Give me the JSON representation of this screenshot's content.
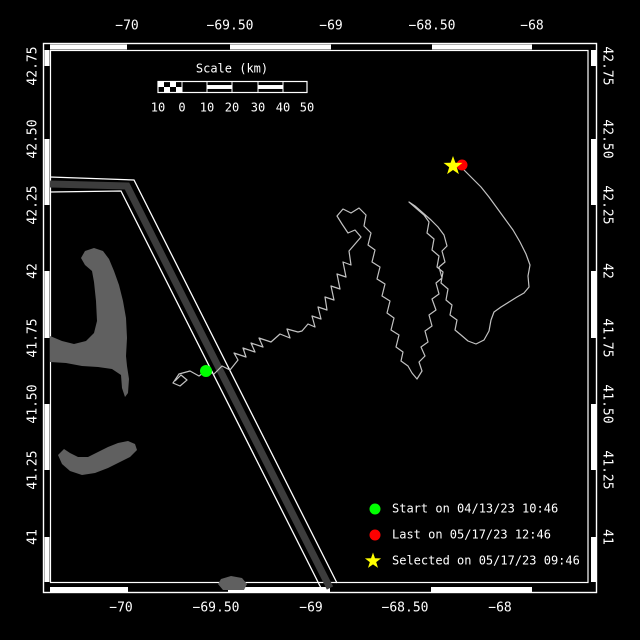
{
  "canvas": {
    "width": 640,
    "height": 640,
    "background": "#000000"
  },
  "frame": {
    "color": "#ffffff",
    "outer": [
      43.5,
      43.5,
      553,
      549
    ],
    "inner": [
      50.5,
      50.5,
      537.5,
      532
    ],
    "zebra": {
      "thickness": 5,
      "top_white": [
        [
          50,
          127
        ],
        [
          230,
          331
        ],
        [
          432,
          532
        ]
      ],
      "bottom_white": [
        [
          50,
          128
        ],
        [
          228,
          330
        ],
        [
          431,
          532
        ]
      ],
      "left_white": [
        [
          50,
          66
        ],
        [
          139,
          205
        ],
        [
          271,
          338
        ],
        [
          404,
          470
        ],
        [
          537,
          582
        ]
      ],
      "right_white": [
        [
          50,
          66
        ],
        [
          139,
          205
        ],
        [
          271,
          338
        ],
        [
          404,
          470
        ],
        [
          537,
          582
        ]
      ]
    }
  },
  "axes": {
    "top": {
      "y": 26,
      "labels": [
        {
          "text": "−70",
          "x": 127
        },
        {
          "text": "−69.50",
          "x": 230
        },
        {
          "text": "−69",
          "x": 331
        },
        {
          "text": "−68.50",
          "x": 432
        },
        {
          "text": "−68",
          "x": 532
        }
      ]
    },
    "bottom": {
      "y": 608,
      "labels": [
        {
          "text": "−70",
          "x": 121
        },
        {
          "text": "−69.50",
          "x": 216
        },
        {
          "text": "−69",
          "x": 311
        },
        {
          "text": "−68.50",
          "x": 405
        },
        {
          "text": "−68",
          "x": 500
        }
      ]
    },
    "left": {
      "x": 33,
      "labels": [
        {
          "text": "42.75",
          "y": 66
        },
        {
          "text": "42.50",
          "y": 139
        },
        {
          "text": "42.25",
          "y": 205
        },
        {
          "text": "42",
          "y": 271
        },
        {
          "text": "41.75",
          "y": 338
        },
        {
          "text": "41.50",
          "y": 404
        },
        {
          "text": "41.25",
          "y": 470
        },
        {
          "text": "41",
          "y": 537
        }
      ]
    },
    "right": {
      "x": 607,
      "labels": [
        {
          "text": "42.75",
          "y": 66
        },
        {
          "text": "42.50",
          "y": 139
        },
        {
          "text": "42.25",
          "y": 205
        },
        {
          "text": "42",
          "y": 271
        },
        {
          "text": "41.75",
          "y": 338
        },
        {
          "text": "41.50",
          "y": 404
        },
        {
          "text": "41.25",
          "y": 470
        },
        {
          "text": "41",
          "y": 537
        }
      ]
    }
  },
  "scale_bar": {
    "title": "Scale (km)",
    "title_x": 232,
    "title_y": 69,
    "bar": {
      "x": 158,
      "y": 81.5,
      "w": 149,
      "h": 11,
      "checker_end": 182,
      "sections": [
        182,
        207,
        232,
        258,
        283
      ],
      "striped": [
        [
          207,
          232
        ],
        [
          258,
          283
        ]
      ]
    },
    "numbers_y": 108,
    "numbers": [
      {
        "text": "10",
        "x": 158
      },
      {
        "text": "0",
        "x": 182
      },
      {
        "text": "10",
        "x": 207
      },
      {
        "text": "20",
        "x": 232
      },
      {
        "text": "30",
        "x": 258
      },
      {
        "text": "40",
        "x": 283
      },
      {
        "text": "50",
        "x": 307
      }
    ]
  },
  "legend": {
    "x_marker": 375,
    "x_text": 392,
    "rows": [
      {
        "type": "circle",
        "color": "#00ff00",
        "label": "Start on 04/13/23 10:46",
        "y": 509
      },
      {
        "type": "circle",
        "color": "#ff0000",
        "label": "Last on 05/17/23 12:46",
        "y": 535
      },
      {
        "type": "star",
        "color": "#ffff00",
        "label": "Selected on 05/17/23 09:46",
        "y": 561
      }
    ]
  },
  "land": {
    "color": "#606060",
    "polygons": [
      [
        [
          50,
          336
        ],
        [
          62,
          341
        ],
        [
          74,
          344
        ],
        [
          86,
          341
        ],
        [
          94,
          333
        ],
        [
          97,
          321
        ],
        [
          96,
          301
        ],
        [
          94,
          282
        ],
        [
          92,
          271
        ],
        [
          85,
          265
        ],
        [
          81,
          258
        ],
        [
          85,
          251
        ],
        [
          94,
          248
        ],
        [
          103,
          251
        ],
        [
          109,
          259
        ],
        [
          114,
          271
        ],
        [
          119,
          285
        ],
        [
          123,
          301
        ],
        [
          126,
          318
        ],
        [
          127,
          338
        ],
        [
          126,
          356
        ],
        [
          127,
          366
        ],
        [
          129,
          379
        ],
        [
          128,
          393
        ],
        [
          125,
          397
        ],
        [
          122,
          388
        ],
        [
          121,
          375
        ],
        [
          112,
          369
        ],
        [
          98,
          367
        ],
        [
          82,
          366
        ],
        [
          66,
          363
        ],
        [
          50,
          362
        ]
      ],
      [
        [
          58,
          455
        ],
        [
          64,
          449
        ],
        [
          70,
          453
        ],
        [
          78,
          457
        ],
        [
          88,
          457
        ],
        [
          98,
          452
        ],
        [
          108,
          447
        ],
        [
          118,
          443
        ],
        [
          128,
          441
        ],
        [
          135,
          444
        ],
        [
          137,
          450
        ],
        [
          130,
          457
        ],
        [
          120,
          462
        ],
        [
          108,
          468
        ],
        [
          95,
          473
        ],
        [
          82,
          475
        ],
        [
          70,
          471
        ],
        [
          62,
          464
        ]
      ],
      [
        [
          221,
          579
        ],
        [
          231,
          576
        ],
        [
          242,
          578
        ],
        [
          247,
          584
        ],
        [
          244,
          590
        ],
        [
          223,
          590
        ],
        [
          218,
          584
        ]
      ]
    ]
  },
  "lane": {
    "band_color": "#3c3c3c",
    "band_width": 7,
    "edge_color": "#ffffff",
    "edge_width": 1.3,
    "band": [
      [
        50,
        184
      ],
      [
        127,
        186
      ],
      [
        330,
        588
      ]
    ],
    "edges": [
      [
        [
          50,
          177
        ],
        [
          134,
          180
        ],
        [
          337,
          583
        ]
      ],
      [
        [
          50,
          192
        ],
        [
          121,
          191
        ],
        [
          322,
          590
        ]
      ]
    ]
  },
  "track": {
    "color": "#c2c2c2",
    "width": 1.2,
    "points": [
      [
        175,
        381
      ],
      [
        181,
        375
      ],
      [
        187,
        380
      ],
      [
        180,
        386
      ],
      [
        173,
        383
      ],
      [
        179,
        374
      ],
      [
        190,
        371
      ],
      [
        199,
        376
      ],
      [
        206,
        371
      ],
      [
        214,
        374
      ],
      [
        222,
        366
      ],
      [
        230,
        370
      ],
      [
        238,
        360
      ],
      [
        234,
        353
      ],
      [
        246,
        357
      ],
      [
        243,
        348
      ],
      [
        255,
        352
      ],
      [
        251,
        343
      ],
      [
        263,
        347
      ],
      [
        259,
        338
      ],
      [
        271,
        342
      ],
      [
        280,
        334
      ],
      [
        290,
        338
      ],
      [
        287,
        329
      ],
      [
        298,
        332
      ],
      [
        302,
        331
      ],
      [
        308,
        324
      ],
      [
        315,
        327
      ],
      [
        312,
        316
      ],
      [
        321,
        319
      ],
      [
        318,
        307
      ],
      [
        327,
        310
      ],
      [
        325,
        297
      ],
      [
        334,
        300
      ],
      [
        331,
        286
      ],
      [
        340,
        289
      ],
      [
        337,
        274
      ],
      [
        346,
        277
      ],
      [
        343,
        262
      ],
      [
        351,
        265
      ],
      [
        349,
        251
      ],
      [
        355,
        244
      ],
      [
        361,
        237
      ],
      [
        355,
        230
      ],
      [
        348,
        233
      ],
      [
        342,
        224
      ],
      [
        337,
        216
      ],
      [
        343,
        209
      ],
      [
        351,
        213
      ],
      [
        359,
        208
      ],
      [
        366,
        215
      ],
      [
        364,
        226
      ],
      [
        371,
        233
      ],
      [
        368,
        245
      ],
      [
        375,
        250
      ],
      [
        372,
        262
      ],
      [
        380,
        267
      ],
      [
        377,
        279
      ],
      [
        385,
        284
      ],
      [
        382,
        296
      ],
      [
        390,
        301
      ],
      [
        387,
        313
      ],
      [
        394,
        318
      ],
      [
        391,
        330
      ],
      [
        399,
        335
      ],
      [
        396,
        347
      ],
      [
        403,
        352
      ],
      [
        401,
        361
      ],
      [
        408,
        366
      ],
      [
        412,
        373
      ],
      [
        417,
        379
      ],
      [
        422,
        371
      ],
      [
        419,
        362
      ],
      [
        425,
        356
      ],
      [
        421,
        347
      ],
      [
        428,
        342
      ],
      [
        425,
        331
      ],
      [
        432,
        326
      ],
      [
        429,
        315
      ],
      [
        436,
        310
      ],
      [
        432,
        299
      ],
      [
        439,
        294
      ],
      [
        436,
        283
      ],
      [
        442,
        278
      ],
      [
        439,
        267
      ],
      [
        445,
        262
      ],
      [
        442,
        251
      ],
      [
        447,
        246
      ],
      [
        444,
        235
      ],
      [
        438,
        227
      ],
      [
        431,
        220
      ],
      [
        423,
        213
      ],
      [
        415,
        206
      ],
      [
        409,
        202
      ],
      [
        417,
        209
      ],
      [
        424,
        215
      ],
      [
        429,
        222
      ],
      [
        427,
        233
      ],
      [
        434,
        239
      ],
      [
        432,
        250
      ],
      [
        439,
        256
      ],
      [
        437,
        267
      ],
      [
        443,
        272
      ],
      [
        441,
        283
      ],
      [
        448,
        289
      ],
      [
        446,
        300
      ],
      [
        452,
        305
      ],
      [
        450,
        315
      ],
      [
        457,
        320
      ],
      [
        455,
        330
      ],
      [
        461,
        335
      ],
      [
        468,
        341
      ],
      [
        476,
        344
      ],
      [
        484,
        340
      ],
      [
        489,
        331
      ],
      [
        491,
        320
      ],
      [
        494,
        312
      ],
      [
        501,
        307
      ],
      [
        509,
        302
      ],
      [
        517,
        297
      ],
      [
        524,
        293
      ],
      [
        529,
        287
      ],
      [
        528,
        276
      ],
      [
        530,
        265
      ],
      [
        526,
        254
      ],
      [
        520,
        242
      ],
      [
        513,
        230
      ],
      [
        505,
        219
      ],
      [
        497,
        208
      ],
      [
        489,
        197
      ],
      [
        481,
        187
      ],
      [
        472,
        178
      ],
      [
        464,
        170
      ],
      [
        460,
        166
      ],
      [
        462,
        165
      ]
    ]
  },
  "markers": {
    "start": {
      "x": 206,
      "y": 371,
      "r": 6,
      "color": "#00ff00"
    },
    "last": {
      "x": 462,
      "y": 165,
      "r": 5.5,
      "color": "#ff0000"
    },
    "selected": {
      "x": 453,
      "y": 166,
      "R": 10,
      "r": 4,
      "color": "#ffff00"
    }
  }
}
